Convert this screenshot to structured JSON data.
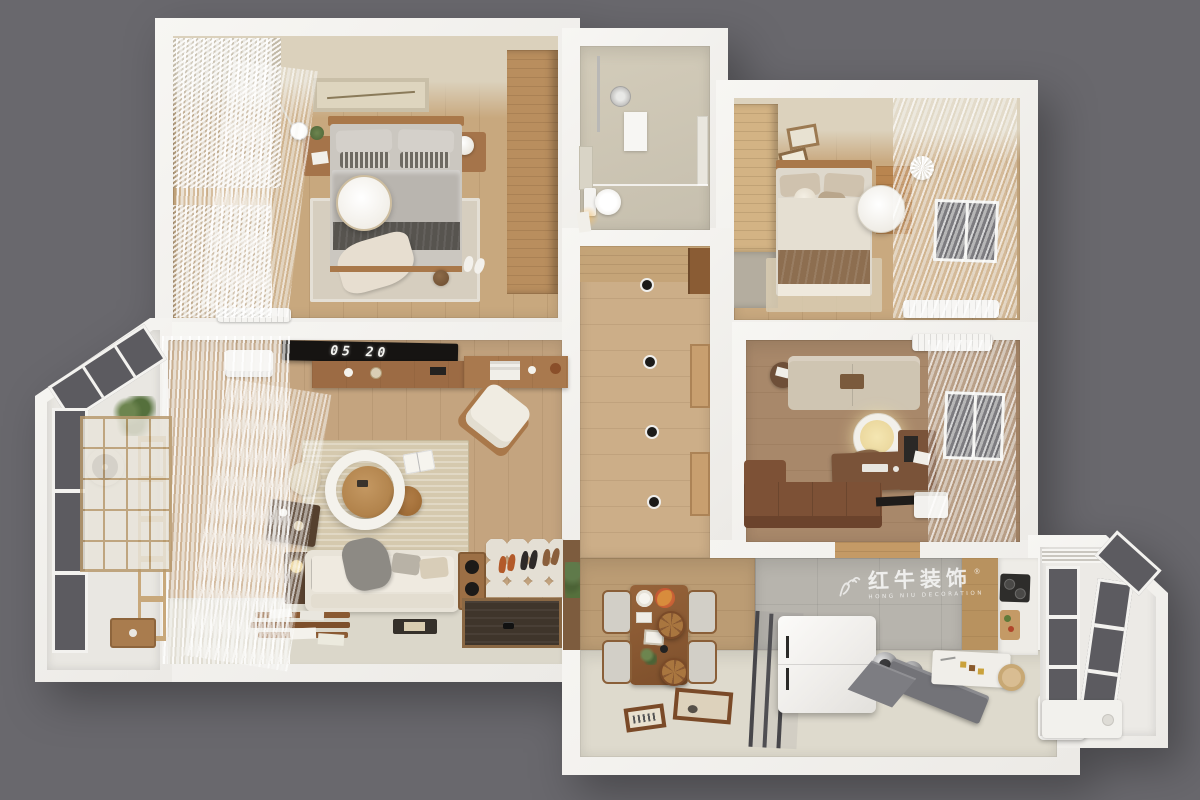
{
  "scene": {
    "description": "3D top-down dollhouse render of a two-bedroom apartment",
    "background_color": "#69686d",
    "wall_color": "#f2f1ee"
  },
  "watermark": {
    "brand": "红牛装饰",
    "brand_en": "HONG NIU DECORATION",
    "registered": "®",
    "logo": "bull-logo-icon",
    "color": "rgba(255,255,255,0.78)"
  },
  "living_room": {
    "tv_clock": "05 20"
  },
  "palette": {
    "wood_light": "#c8a87e",
    "wood_mid": "#9c6b44",
    "wood_dark": "#7a5339",
    "floor_cream": "#dbd7ca",
    "tile_gray": "#b7b4ad",
    "glass_dark": "#5c5b60",
    "rug_beige": "#d5c9ae",
    "sofa_cream": "#e8e3d8",
    "sofa_brown": "#7d5136",
    "lamp_warm": "#f0e0a8"
  }
}
